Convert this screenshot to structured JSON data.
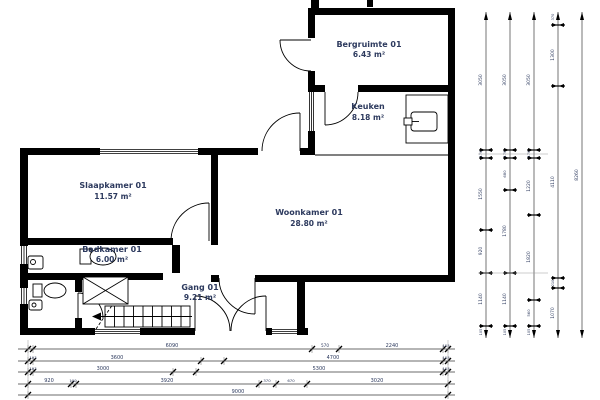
{
  "rooms": [
    {
      "name": "Bergruimte 01",
      "area": "6.43 m²"
    },
    {
      "name": "Keuken",
      "area": "8.18 m²"
    },
    {
      "name": "Slaapkamer 01",
      "area": "11.57 m²"
    },
    {
      "name": "Woonkamer 01",
      "area": "28.80 m²"
    },
    {
      "name": "Badkamer 01",
      "area": "6.00 m²"
    },
    {
      "name": "Gang 01",
      "area": "9.21 m²"
    }
  ],
  "dimensions": {
    "bottom_rows": [
      [
        "6090",
        "570",
        "2240",
        "103"
      ],
      [
        "103",
        "3600",
        "4700",
        "103"
      ],
      [
        "103",
        "3000",
        "5300",
        "103"
      ],
      [
        "920",
        "100",
        "3920",
        "370",
        "670",
        "3020"
      ],
      [
        "9000"
      ]
    ],
    "right_cols": [
      [
        "3050",
        "170",
        "1550",
        "920",
        "1140",
        "105"
      ],
      [
        "3050",
        "170",
        "680",
        "1780",
        "1140",
        "105"
      ],
      [
        "3050",
        "170",
        "1220",
        "1820",
        "560",
        "105"
      ],
      [
        "370",
        "1300",
        "4110",
        "210",
        "1070"
      ],
      [
        "8260"
      ]
    ]
  },
  "colors": {
    "wall": "#000000",
    "label_text": "#2d3a5e",
    "dim_text": "#39456e"
  }
}
